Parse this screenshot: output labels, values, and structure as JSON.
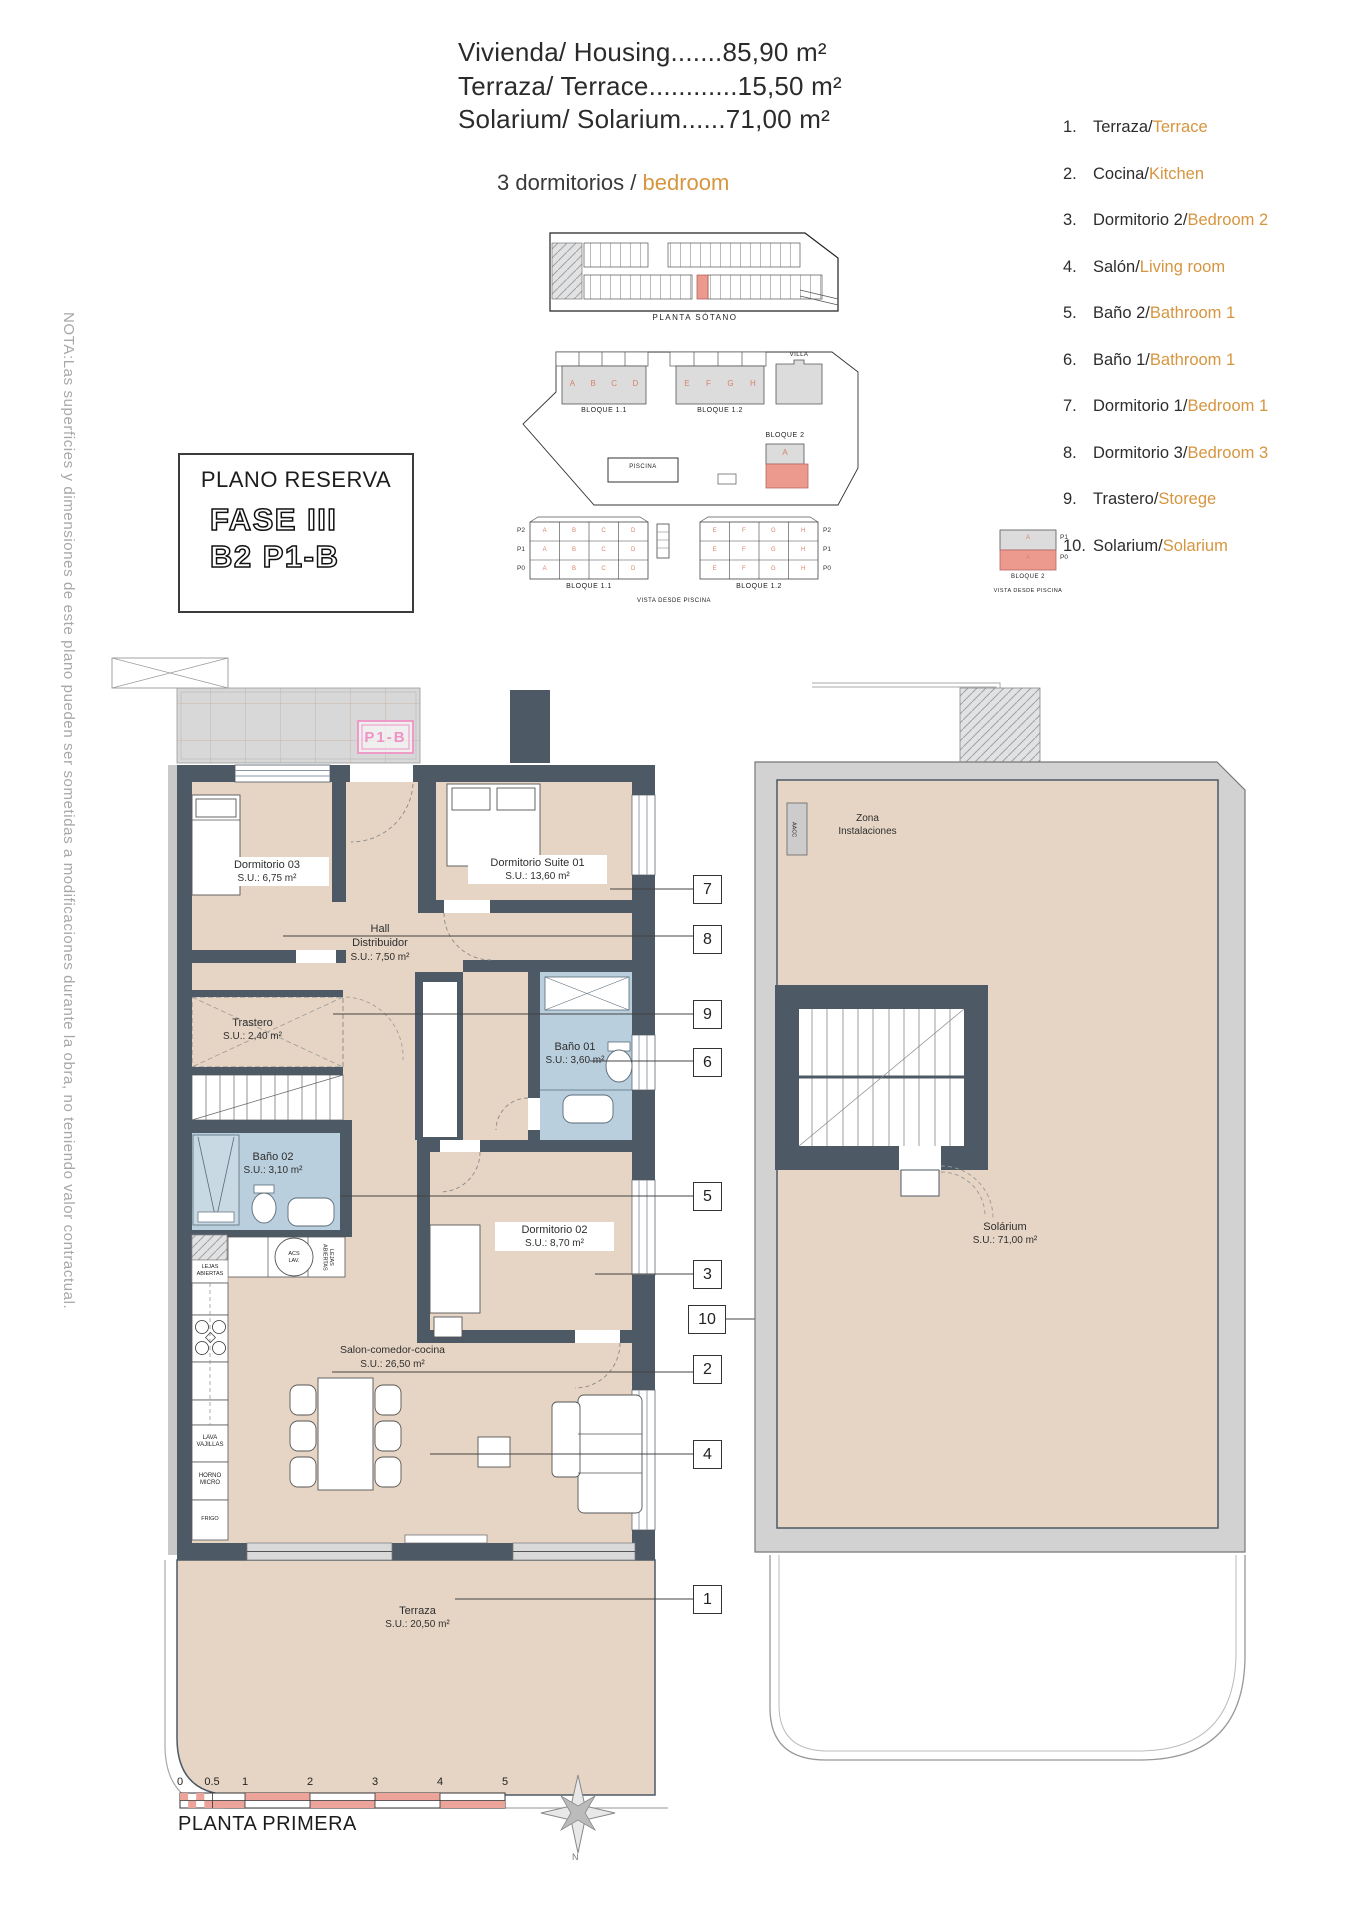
{
  "header": {
    "lines": [
      "Vivienda/ Housing.......85,90 m²",
      "Terraza/ Terrace............15,50 m²",
      "Solarium/ Solarium......71,00 m²"
    ],
    "subtitle_black": "3 dormitorios / ",
    "subtitle_orange": "bedroom"
  },
  "title_box": {
    "title": "PLANO RESERVA",
    "phase": "FASE III",
    "unit": "B2 P1-B"
  },
  "note_vertical": "NOTA:Las superficies y dimensiones de este plano pueden ser sometidas a modificaciones durante la obra, no teniendo valor contractual.",
  "legend": {
    "separator": " / ",
    "items": [
      {
        "num": "1.",
        "es": "Terraza",
        "en": "Terrace"
      },
      {
        "num": "2.",
        "es": "Cocina",
        "en": "Kitchen"
      },
      {
        "num": "3.",
        "es": "Dormitorio 2",
        "en": "Bedroom 2"
      },
      {
        "num": "4.",
        "es": "Salón",
        "en": "Living room"
      },
      {
        "num": "5.",
        "es": "Baño 2",
        "en": "Bathroom 1"
      },
      {
        "num": "6.",
        "es": "Baño 1",
        "en": "Bathroom 1"
      },
      {
        "num": "7.",
        "es": "Dormitorio 1",
        "en": "Bedroom 1"
      },
      {
        "num": "8.",
        "es": "Dormitorio 3",
        "en": "Bedroom 3"
      },
      {
        "num": "9.",
        "es": "Trastero",
        "en": "Storege"
      },
      {
        "num": "10.",
        "es": "Solarium",
        "en": "Solarium"
      }
    ]
  },
  "site": {
    "basement_label": "PLANTA SÓTANO",
    "bloque11": "BLOQUE 1.1",
    "bloque12": "BLOQUE 1.2",
    "bloque2": "BLOQUE 2",
    "villa": "VILLA",
    "piscina": "PISCINA",
    "vista": "VISTA DESDE PISCINA",
    "units_left": [
      "A",
      "B",
      "C",
      "D"
    ],
    "units_right": [
      "E",
      "F",
      "G",
      "H"
    ],
    "rows": [
      "P2",
      "P1",
      "P0"
    ],
    "bloque2_rows": [
      "P1",
      "P0"
    ],
    "bloque2_unit": "A"
  },
  "plan": {
    "unit_label": "P1-B",
    "rooms": {
      "d03": {
        "name": "Dormitorio 03",
        "area": "S.U.: 6,75 m²"
      },
      "suite": {
        "name": "Dormitorio Suite 01",
        "area": "S.U.: 13,60 m²"
      },
      "hall": {
        "name": "Hall",
        "name2": "Distribuidor",
        "area": "S.U.: 7,50 m²"
      },
      "trastero": {
        "name": "Trastero",
        "area": "S.U.: 2,40 m²"
      },
      "bano01": {
        "name": "Baño 01",
        "area": "S.U.: 3,60 m²"
      },
      "bano02": {
        "name": "Baño 02",
        "area": "S.U.: 3,10 m²"
      },
      "d02": {
        "name": "Dormitorio 02",
        "area": "S.U.: 8,70 m²"
      },
      "salon": {
        "name": "Salon-comedor-cocina",
        "area": "S.U.: 26,50 m²"
      },
      "terraza": {
        "name": "Terraza",
        "area": "S.U.: 20,50 m²"
      }
    },
    "kitchen": {
      "shelf": "LEJAS ABIERTAS",
      "shelf_vertical": "LEJAS ABIERTAS",
      "boiler": "ACS LAV.",
      "dishwasher": "LAVA VAJILLAS",
      "oven": "HORNO MICRO",
      "fridge": "FRIGO"
    },
    "callouts": [
      "7",
      "8",
      "9",
      "6",
      "5",
      "3",
      "10",
      "2",
      "4",
      "1"
    ]
  },
  "solarium": {
    "name": "Solárium",
    "area": "S.U.: 71,00 m²",
    "zona1": "Zona",
    "zona2": "Instalaciones",
    "aacc": "AACC"
  },
  "footer": {
    "scale_ticks": [
      "0",
      "0.5",
      "1",
      "2",
      "3",
      "4",
      "5"
    ],
    "floor_label": "PLANTA PRIMERA",
    "compass": "N"
  },
  "colors": {
    "wall": "#4d5965",
    "floor_beige": "#e6d5c4",
    "bath_blue": "#b9cfdd",
    "terrace_gray": "#d8d8d8",
    "accent_orange": "#d6953f",
    "unit_salmon": "#d9826b",
    "highlight_red": "#ec9a8d",
    "pink_label": "#ef93c5"
  }
}
